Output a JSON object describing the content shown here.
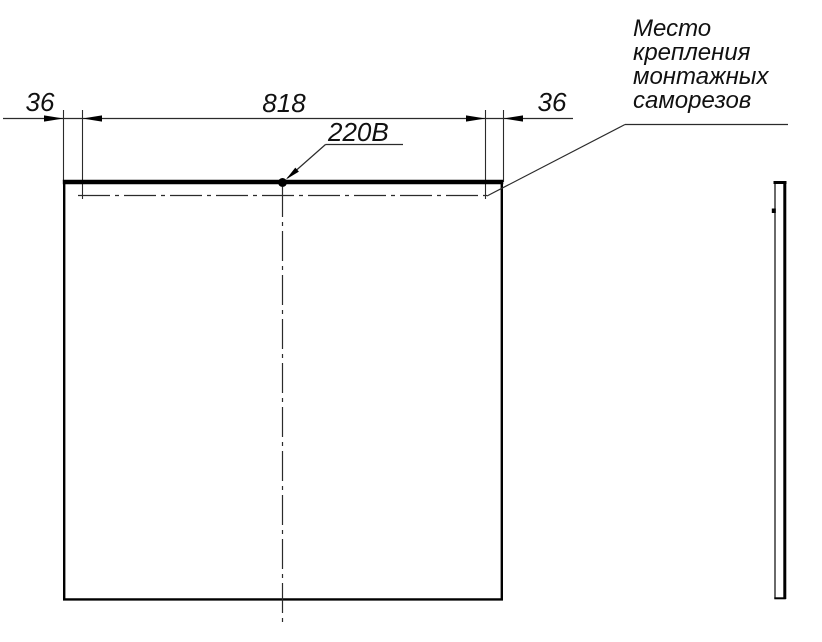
{
  "dimensions": {
    "left": "36",
    "center": "818",
    "right": "36"
  },
  "power_label": "220В",
  "note": {
    "lines": [
      "Место",
      "крепления",
      "монтажных",
      "саморезов"
    ]
  },
  "colors": {
    "line": "#000000",
    "thin_line": "#2b2b2b",
    "background": "#ffffff"
  }
}
